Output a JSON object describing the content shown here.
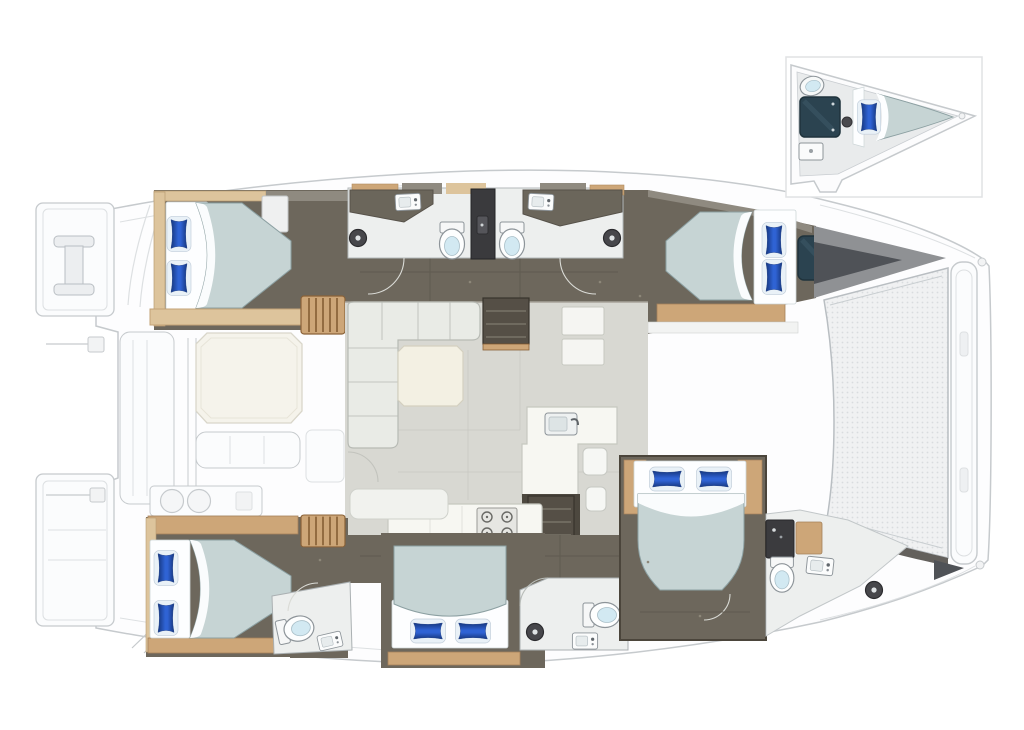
{
  "palette": {
    "bg": "#ffffff",
    "ghost": "#c6cacd",
    "ghostSoft": "#dde0e2",
    "deck": "#fcfcfd",
    "deckShade": "#f4f5f6",
    "floorDark": "#6d675c",
    "floorDarkEdge": "#4b453b",
    "wallGray": "#8f8a80",
    "wood": "#cda678",
    "woodDark": "#8a6238",
    "woodLight": "#ddc49c",
    "bathFloor": "#edefee",
    "fixtureLine": "#8d9499",
    "toiletLid": "#d2e9f2",
    "darkUnit": "#3b3b3e",
    "duvet": "#c6d4d4",
    "duvetEdge": "#8ca0a2",
    "sheet": "#fdfeff",
    "pillowMid": "#2f63d4",
    "pillowDeep": "#16377f",
    "pillowCase": "#e9f1f7",
    "saloonFloor": "#d8d8d2",
    "saloonSeam": "#c9c9c3",
    "sofa": "#e9ebe6",
    "sofaLine": "#b7bab4",
    "tableCream": "#f3f0e3",
    "counter": "#f7f7f2",
    "counterLine": "#c6c8c0",
    "stove": "#e6e6e2",
    "burner": "#6a6a66",
    "hatch": "#2b4350",
    "hatchEdge": "#1f333c",
    "bowWedge": "#8f9194",
    "bowWedgeDark": "#4f5257",
    "tramp": "#f0f1f2",
    "trampDot": "#d9dcde",
    "insetBorder": "#e0e2e4",
    "arcOnDark": "#dadbd6",
    "arcOnLight": "#c2c3bd"
  },
  "scene": {
    "kind": "catamaran-interior-floorplan",
    "orientation": {
      "bow": "right",
      "stern": "left"
    },
    "inset": {
      "position": "top-right",
      "shows": "forepeak-cabin-detail",
      "beds": 1,
      "toilets": 1,
      "hatches": 1
    },
    "rooms": [
      {
        "id": "cabin-aft-port",
        "beds": 1,
        "pillows": 2
      },
      {
        "id": "cabin-fwd-port",
        "beds": 1,
        "pillows": 2,
        "hatches": 1
      },
      {
        "id": "cabin-aft-starboard",
        "beds": 1,
        "pillows": 2
      },
      {
        "id": "cabin-mid-starboard",
        "beds": 1,
        "pillows": 2
      },
      {
        "id": "cabin-fwd-starboard",
        "beds": 1,
        "pillows": 2
      },
      {
        "id": "head-port-aft",
        "toilets": 1,
        "sinks": 1,
        "showers": 1
      },
      {
        "id": "head-port-fwd",
        "toilets": 1,
        "sinks": 1,
        "showers": 1
      },
      {
        "id": "head-starboard-aft",
        "toilets": 1,
        "sinks": 1
      },
      {
        "id": "head-starboard-mid",
        "toilets": 1,
        "sinks": 1,
        "showers": 1
      },
      {
        "id": "head-starboard-fwd",
        "toilets": 1,
        "sinks": 1,
        "showers": 1
      }
    ],
    "saloon": {
      "sofas": 1,
      "tables": 1,
      "galley_island": 1,
      "stove_burners": 4,
      "sinks": 2,
      "fridge_units": 2,
      "stairways_to_hulls": 2
    },
    "cockpit": {
      "tables": 1,
      "benches": 2,
      "grill_burners": 2
    },
    "foredeck": {
      "trampoline": true,
      "crossbeam": true
    },
    "totals": {
      "double_beds_main_plan": 5,
      "beds_in_inset": 1,
      "toilets_visible": 6,
      "shower_heads_visible": 4,
      "blue_pillows_visible": 11
    }
  }
}
